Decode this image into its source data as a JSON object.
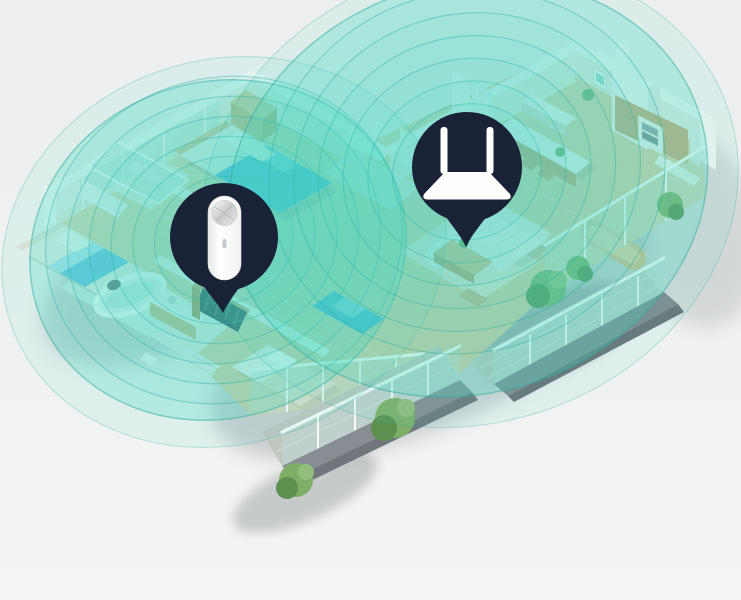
{
  "scene": {
    "description": "Isometric 3D apartment floor plan showing Wi-Fi coverage: a router marker and a range-extender marker, each emitting concentric teal signal circles over the rooms, bedrooms with blue beds, dining and kitchen area, sofa, and balconies with plants",
    "background": "#edefee"
  },
  "palette": {
    "bg": "#edefee",
    "navy": "#1a2238",
    "teal": "#41d9c1",
    "tealStroke": "#2fae9d",
    "wood": "#e2d1ac",
    "woodDark": "#d6c098",
    "wallWhite": "#f8f8f6",
    "wallShade": "#ededeb",
    "glass": "#bfe2db",
    "concrete": "#c2c6c0",
    "concreteDark": "#81878c",
    "plant": "#7fae68",
    "plantDark": "#5d8f4e",
    "bedBlue": "#58b4e0",
    "device": "#fdfdfc"
  },
  "markers": {
    "extender": {
      "icon": "wifi-extender-icon",
      "shape": "pin-bubble"
    },
    "router": {
      "icon": "wifi-router-icon",
      "shape": "pin-bubble"
    }
  },
  "coverage": {
    "ring_axis_ratio": 0.9,
    "rotation_deg": -18,
    "left": {
      "cx": 224,
      "cy": 240,
      "rings": [
        70,
        92,
        114,
        136,
        158,
        180
      ],
      "main": {
        "cx": 218,
        "cy": 250,
        "rx": 190,
        "ry": 168
      },
      "halo": {
        "cx": 224,
        "cy": 252,
        "rx": 225,
        "ry": 192
      }
    },
    "right": {
      "cx": 467,
      "cy": 172,
      "rings": [
        75,
        100,
        125,
        150,
        175,
        200
      ],
      "main": {
        "cx": 468,
        "cy": 188,
        "rx": 243,
        "ry": 205
      },
      "halo": {
        "cx": 470,
        "cy": 195,
        "rx": 272,
        "ry": 228
      }
    }
  }
}
